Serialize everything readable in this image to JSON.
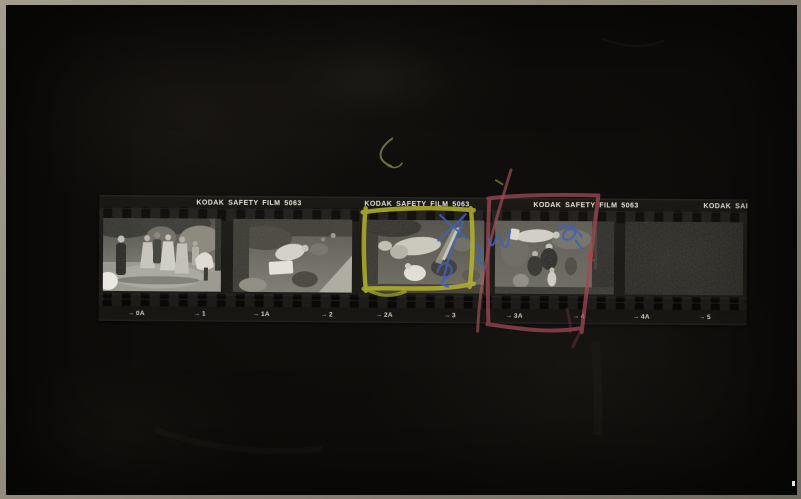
{
  "print": {
    "description": "Black-and-white photographic contact sheet: a strip of five 35mm negatives contact-printed onto black photographic paper with a light paper edge",
    "paper_border_color": "#8f897c",
    "field_color": "#0e0c0a"
  },
  "film": {
    "edge_text": "KODAK SAFETY FILM 5063",
    "edge_text_partial": "KODAK SAF",
    "edge_text_color": "#e6e3d8",
    "marker_color": "#d3cfc0",
    "markers": [
      {
        "arrow": "→",
        "label": "0A"
      },
      {
        "arrow": "→",
        "label": "1"
      },
      {
        "arrow": "→",
        "label": "1A"
      },
      {
        "arrow": "→",
        "label": "2"
      },
      {
        "arrow": "→",
        "label": "2A"
      },
      {
        "arrow": "→",
        "label": "3"
      },
      {
        "arrow": "→",
        "label": "3A"
      },
      {
        "arrow": "→",
        "label": "4"
      },
      {
        "arrow": "→",
        "label": "4A"
      },
      {
        "arrow": "→",
        "label": "5"
      }
    ],
    "frames": [
      {
        "id": "0A",
        "content": "group of people standing in a courtyard, man in dark suit at left"
      },
      {
        "id": "1A",
        "content": "garden scene with figures and white table, camera rotated 90 degrees"
      },
      {
        "id": "2A",
        "content": "figures in light clothing with light flare streak, camera rotated 90 degrees; selected with yellow grease-pencil box and blue pen X"
      },
      {
        "id": "3A",
        "content": "standing group portrait, camera rotated 90 degrees; selected with red grease-pencil box and blue pen marks"
      },
      {
        "id": "4A",
        "content": "blank unexposed frame"
      }
    ]
  },
  "annotations": {
    "yellow_grease_pencil": "#b9b92a",
    "red_grease_pencil": "#a04a55",
    "pink_line": "#b05a62",
    "blue_ballpoint": "#3f62b8",
    "red_speck": "#c23b35",
    "scratch_yellow_green": "#a2a258"
  }
}
